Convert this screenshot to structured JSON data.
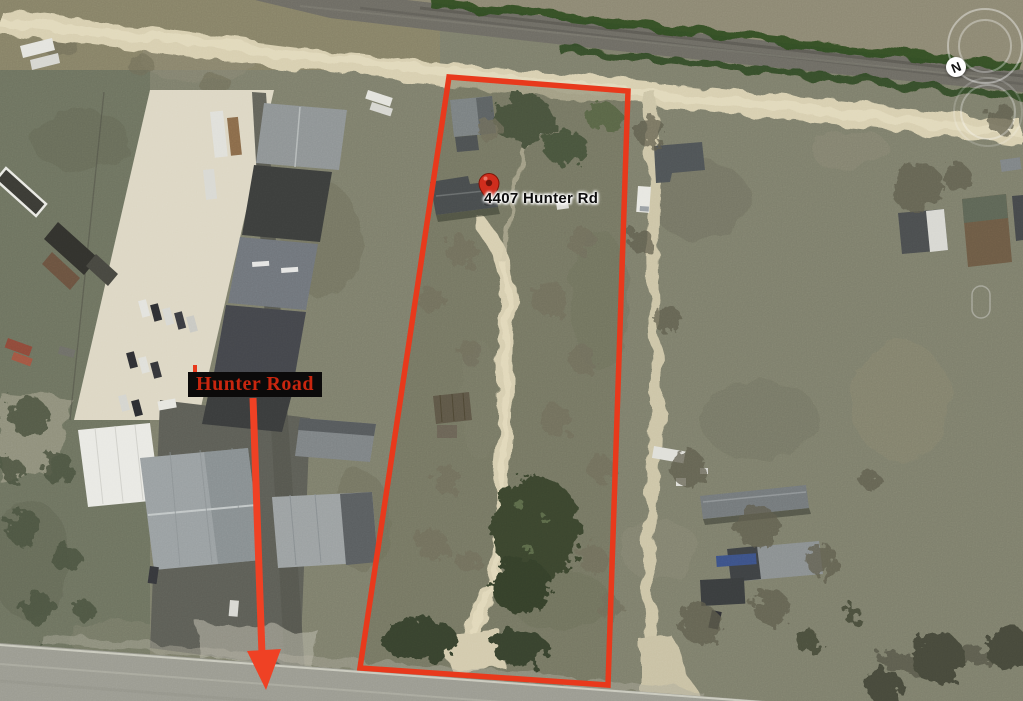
{
  "annotations": {
    "parcel_outline": {
      "color": "#e8391c"
    },
    "address_pin": {
      "label": "4407 Hunter Rd",
      "pin_color": "#cf2d1d",
      "text_color": "#0d0d0d"
    },
    "road_label": {
      "text": "Hunter Road",
      "text_color": "#c9260f",
      "background_color": "#0b0a0a"
    },
    "arrow": {
      "color": "#ef4124"
    },
    "compass": {
      "label": "N"
    }
  }
}
